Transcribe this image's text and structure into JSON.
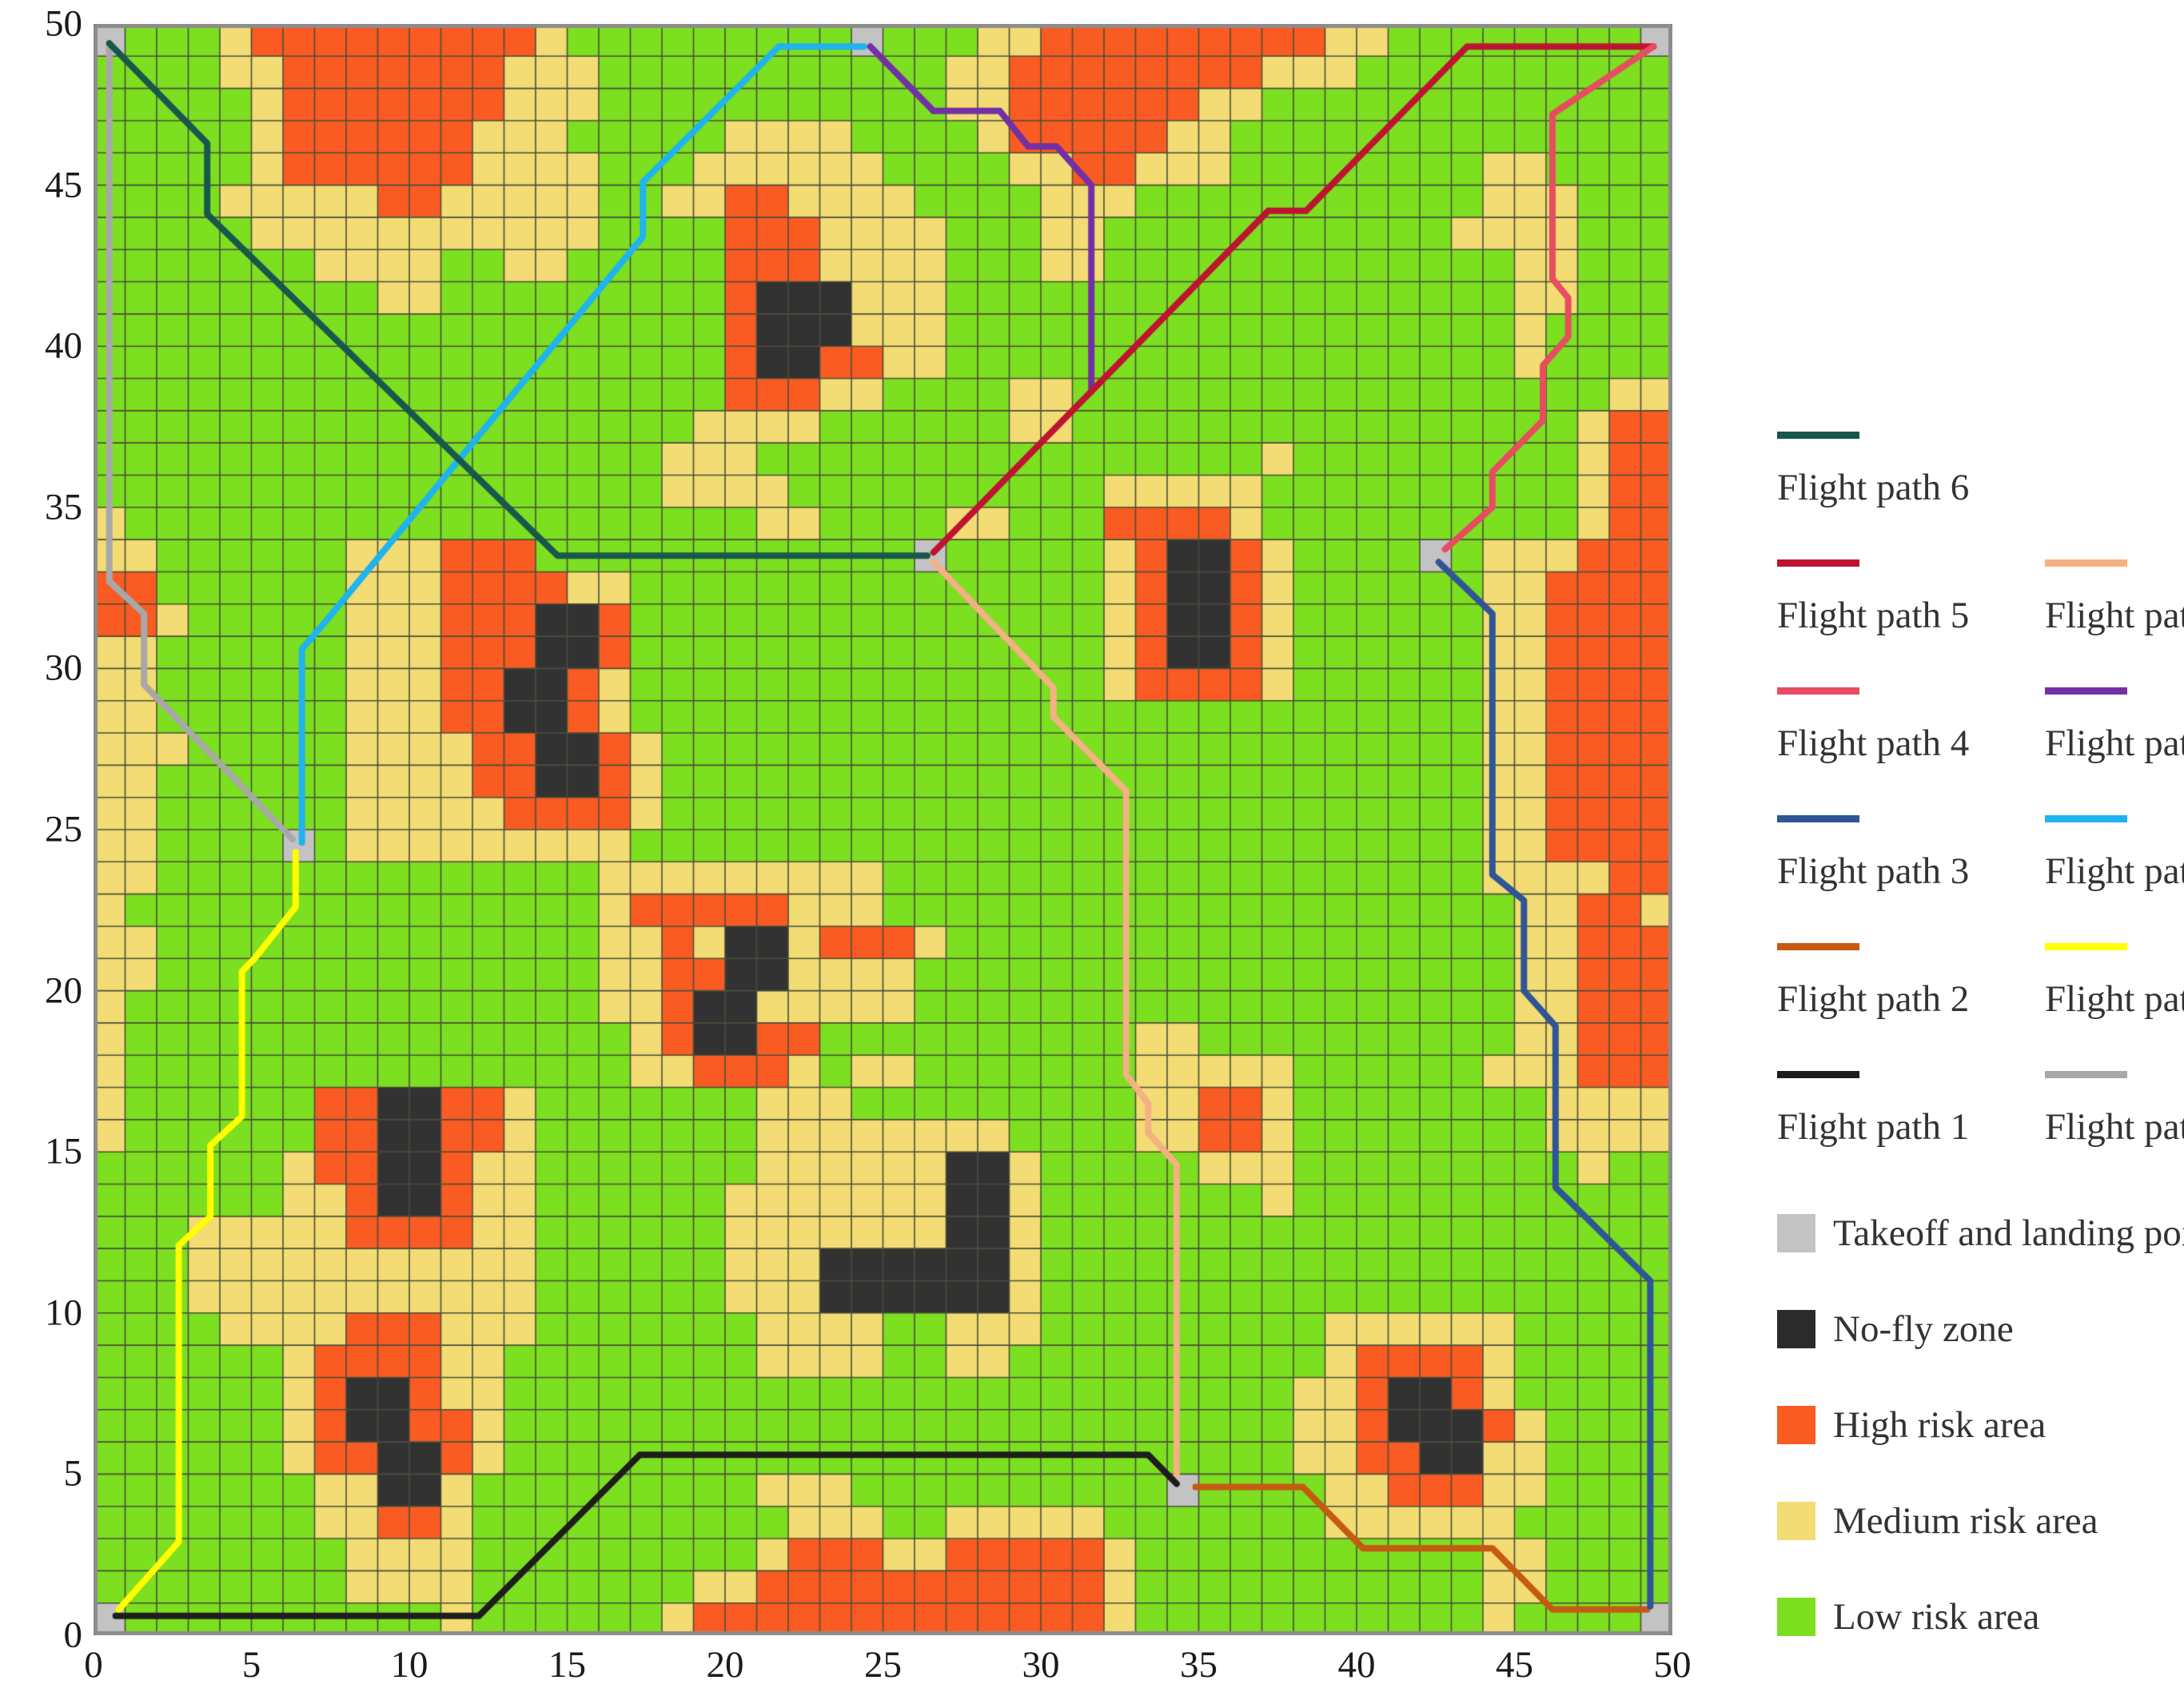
{
  "chart_data": {
    "type": "heatmap",
    "title": "UAV flight paths over gridded risk map",
    "x_axis": {
      "min": 0,
      "max": 50,
      "ticks": [
        0,
        5,
        10,
        15,
        20,
        25,
        30,
        35,
        40,
        45,
        50
      ]
    },
    "y_axis": {
      "min": 0,
      "max": 50,
      "ticks": [
        0,
        5,
        10,
        15,
        20,
        25,
        30,
        35,
        40,
        45,
        50
      ]
    },
    "grid_on": true,
    "cell_codes": {
      "G": "Low risk area",
      "M": "Medium risk area",
      "H": "High risk area",
      "N": "No-fly zone",
      "T": "Takeoff and landing points"
    },
    "colors": {
      "G": "#7cdf1f",
      "M": "#f2dc73",
      "H": "#f95b22",
      "N": "#323232",
      "T": "#c3c3c3",
      "grid_line": "#4a4e3b",
      "border": "#8c8c8c"
    },
    "grid_rows_top_to_bottom": [
      "TGGGMHHHHHHHHHMGGGGGGGGGTGGGMMHHHHHHHHHMMGGGGGGGGT",
      "GGGGMMHHHHHHHMMMGGGGGGGGGGGMMHHHHHHHHMMMGGGGGGGGGG",
      "GGGGGMHHHHHHHMMMGGGGGGGGGGGMMHHHHHHMMGGGGGGGGGGGGG",
      "GGGGGMHHHHHHMMMGGGGGMMMMGGGGMHHHHHMMGGGGGGGGGGGGGG",
      "GGGGGMHHHHHHMMMMGGGMMMMMMGGGGMMHHMMMGGGGGGGGMMGGGG",
      "GGGGMMMMMHHMMMMMGGMMHHMMMMGGGGMMMGGGGGGGGGGGMMMGGG",
      "GGGGGMMMMMMMMMMMGGGGHHHMMMMGGGMMGGGGGGGGGGGMMMMGGG",
      "GGGGGGGMMMMGGMMGGGGGHHHMMMMGGGMMGGGGGGGGGGGGGMMGGG",
      "GGGGGGGGGMMGGGGGGGGGHNNNMMMGGGGGGGGGGGGGGGGGGMMGGG",
      "GGGGGGGGGGGGGGGGGGGGHNNNMMMGGGGGGGGGGGGGGGGGGMGGGG",
      "GGGGGGGGGGGGGGGGGGGGHNNHHMMGGGGGGGGGGGGGGGGGGMGGGG",
      "GGGGGGGGGGGGGGGGGGGGHHHMMGGGGMMGGGGGGGGGGGGGGGGGMM",
      "GGGGGGGGGGGGGGGGGGGMMMMGGGGGGMMGGGGGGGGGGGGGGGGMHH",
      "GGGGGGGGGGGGGGGGGGMMMGGGGGGGGGGGGGGGGMGGGGGGGGGMHH",
      "GGGGGGGGGGGGGGGGGGMMMMGGGGGGGGGGMMMMMGGGGGGGGGGMHH",
      "MGGGGGGGGGGGGGGGGGGGGMMGGGGMMGGGHHHHMGGGGGGGGGGMHH",
      "MMGGGGGGMMMHHHGGGGGGGGGGGGTGGGGGMHNNHMGGGGTGMMMHHH",
      "HHGGGGGGMMMHHHHMMGGGGGGGGGGGGGGGMHNNHMGGGGGGMMHHHH",
      "HHMGGGGGMMMHHHNNHGGGGGGGGGGGGGGGMHNNHMGGGGGGMMHHHH",
      "MMGGGGGGMMMHHHNNHGGGGGGGGGGGGGGGMHNNHMGGGGGGMMHHHH",
      "MMGGGGGGMMMHHNNHMGGGGGGGGGGGGGGGMHHHHMGGGGGGMMHHHH",
      "MMGGGGGGMMMHHNNHMGGGGGGGGGGGGGGGGGGGGGGGGGGGMMHHHH",
      "MMMGGGGGMMMMHHNNHMGGGGGGGGGGGGGGGGGGGGGGGGGGMMHHHH",
      "MMGGGGGGMMMMHHNNHMGGGGGGGGGGGGGGGGGGGGGGGGGGMMHHHH",
      "MMGGGGGGMMMMMHHHHMGGGGGGGGGGGGGGGGGGGGGGGGGGMMHHHH",
      "MMGGGGTGMMMMMMMMMGGGGGGGGGGGGGGGGGGGGGGGGGGGMMHHHH",
      "MMGGGGGGGGGGGGGGMMMMMMMMMGGGGGGGGGGGGGGGGGGGMMMMHH",
      "MGGGGGGGGGGGGGGGMHHHHHMMMGGGGGGGGGGGGGGGGGGGGMMHHM",
      "MMGGGGGGGGGGGGGGMMHMNNMHHHMGGGGGGGGGGGGGGGGGGMMHHH",
      "MMGGGGGGGGGGGGGGMMHHNNMMMMGGGGGGGGGGGGGGGGGGGMMHHH",
      "MGGGGGGGGGGGGGGGMMHNNMMMMMGGGGGGGGGGGGGGGGGGGMMHHH",
      "MGGGGGGGGGGGGGGGGMHNNHHGGGGGGGGGGMMGGGGGGGGGGMMHHH",
      "MGGGGGGGGGGGGGGGGMMHHHMGMMGGGGGGGMMMMMGGGGGGMMMHHH",
      "MGGGGGGHHNNHHMGGGGGGGMMMGGGGGGGGGMMHHMGGGGGGGGMMMM",
      "MGGGGGGHHNNHHMGGGGGGGMMMMMMMMGGGGMMHHMGGGGGGGGMMMM",
      "GGGGGGMHHNNHMMGGGGGGGMMMMMMNNMGGGGGMMMGGGGGGGGGMGG",
      "GGGGGGMMHNNHMMGGGGGGMMMMMMMNNMGGGGGGGMGGGGGGGGGGGG",
      "GGGMMMMMHHHHMMGGGGGGMMMMMMMNNMGGGGGGGGGGGGGGGGGGGG",
      "GGGMMMMMMMMMMMGGGGGGMMMNNNNNNMGGGGGGGGGGGGGGGGGGGG",
      "GGGMMMMMMMMMMMGGGGGGMMMNNNNNNMGGGGGGGGGGGGGGGGGGGG",
      "GGGGMMMMHHHMMMGGGGGGGMMMMGGMMMGGGGGGGGGMMMMMMGGGGG",
      "GGGGGGMHHHHMMGGGGGGGGMMMMGGMMGGGGGGGGGGMHHHHMGGGGG",
      "GGGGGGMHNNHMMGGGGGGGGGGGGGGGGGGGGGGGGGMMHNNHMGGGGG",
      "GGGGGGMHNNHHMGGGGGGGGGGGGGGGGGGGGGGGGGMMHNNNHMGGGG",
      "GGGGGGMHHNNHMGGGGGGGGGGGGGGGGGGGGGGGGGMMHHNNMMGGGG",
      "GGGGGGGMMNNMGGGGGGGGGMMMGGGGGGGGGGTGGGGMMHHHMMGGGG",
      "GGGGGGGMMHHMGGGGGGGGGGMMMGGMMMMMGGGGGGGMMMMMMGGGGG",
      "GGGGGGGGMMMMGGGGGGGGGMHHHMMHHHHHMGGGGGGGGGGGMMGGGG",
      "GGGGGGGGMMMMGGGGGGGMMHHHHHHHHHHHMGGGGGGGGGGGMMGGGG",
      "TGGGGGGGGGGMGGGGGGMHHHHHHHHHHHHHMGGGGGGGGGGGMGGGGT"
    ],
    "takeoff_points": [
      [
        0.5,
        0.5
      ],
      [
        0.5,
        49.5
      ],
      [
        24.5,
        49.5
      ],
      [
        49.5,
        49.5
      ],
      [
        6.5,
        24.5
      ],
      [
        26.5,
        33.5
      ],
      [
        42.5,
        33.5
      ],
      [
        34.5,
        4.5
      ],
      [
        49.5,
        0.5
      ]
    ],
    "flight_paths": [
      {
        "name": "Flight path 7",
        "color": "#a8a8a8",
        "points": [
          [
            0.5,
            49.4
          ],
          [
            0.5,
            32.7
          ],
          [
            1.6,
            31.7
          ],
          [
            1.6,
            29.5
          ],
          [
            6.3,
            24.7
          ]
        ]
      },
      {
        "name": "Flight path 9",
        "color": "#1fb3f0",
        "points": [
          [
            6.6,
            24.6
          ],
          [
            6.6,
            30.6
          ],
          [
            7.3,
            31.4
          ],
          [
            17.4,
            43.4
          ],
          [
            17.4,
            45.1
          ],
          [
            21.7,
            49.3
          ],
          [
            24.4,
            49.3
          ]
        ]
      },
      {
        "name": "Flight path 8",
        "color": "#ffff00",
        "points": [
          [
            6.4,
            24.3
          ],
          [
            6.4,
            22.6
          ],
          [
            5.1,
            21.0
          ],
          [
            4.7,
            20.6
          ],
          [
            4.7,
            16.1
          ],
          [
            3.7,
            15.2
          ],
          [
            3.7,
            13.0
          ],
          [
            2.7,
            12.1
          ],
          [
            2.7,
            2.9
          ],
          [
            0.8,
            0.8
          ]
        ]
      },
      {
        "name": "Flight path 6",
        "color": "#18584c",
        "points": [
          [
            0.5,
            49.4
          ],
          [
            3.6,
            46.3
          ],
          [
            3.6,
            44.1
          ],
          [
            14.7,
            33.5
          ],
          [
            26.4,
            33.5
          ]
        ]
      },
      {
        "name": "Flight path 10",
        "color": "#7330a6",
        "points": [
          [
            24.6,
            49.3
          ],
          [
            26.6,
            47.3
          ],
          [
            28.7,
            47.3
          ],
          [
            29.6,
            46.2
          ],
          [
            30.5,
            46.2
          ],
          [
            31.6,
            45.0
          ],
          [
            31.6,
            38.6
          ]
        ]
      },
      {
        "name": "Flight path 5",
        "color": "#bf1332",
        "points": [
          [
            26.6,
            33.6
          ],
          [
            37.2,
            44.2
          ],
          [
            38.4,
            44.2
          ],
          [
            43.5,
            49.3
          ],
          [
            49.4,
            49.3
          ]
        ]
      },
      {
        "name": "Flight path 11",
        "color": "#f4b183",
        "points": [
          [
            26.6,
            33.3
          ],
          [
            30.4,
            29.4
          ],
          [
            30.4,
            28.5
          ],
          [
            32.7,
            26.2
          ],
          [
            32.7,
            17.4
          ],
          [
            33.4,
            16.5
          ],
          [
            33.4,
            15.6
          ],
          [
            34.3,
            14.6
          ],
          [
            34.3,
            5.0
          ]
        ]
      },
      {
        "name": "Flight path 1",
        "color": "#1d1d1d",
        "points": [
          [
            0.7,
            0.6
          ],
          [
            12.2,
            0.6
          ],
          [
            17.3,
            5.6
          ],
          [
            33.4,
            5.6
          ],
          [
            34.3,
            4.7
          ]
        ]
      },
      {
        "name": "Flight path 2",
        "color": "#c55a11",
        "points": [
          [
            34.9,
            4.6
          ],
          [
            38.3,
            4.6
          ],
          [
            40.2,
            2.7
          ],
          [
            44.3,
            2.7
          ],
          [
            46.2,
            0.8
          ],
          [
            49.2,
            0.8
          ]
        ]
      },
      {
        "name": "Flight path 4",
        "color": "#e74c60",
        "points": [
          [
            49.4,
            49.3
          ],
          [
            46.2,
            47.2
          ],
          [
            46.2,
            42.1
          ],
          [
            46.7,
            41.5
          ],
          [
            46.7,
            40.3
          ],
          [
            45.9,
            39.4
          ],
          [
            45.9,
            37.7
          ],
          [
            44.3,
            36.1
          ],
          [
            44.3,
            35.0
          ],
          [
            42.8,
            33.7
          ]
        ]
      },
      {
        "name": "Flight path 3",
        "color": "#2f5597",
        "points": [
          [
            42.6,
            33.3
          ],
          [
            44.3,
            31.7
          ],
          [
            44.3,
            23.6
          ],
          [
            45.3,
            22.8
          ],
          [
            45.3,
            20.0
          ],
          [
            46.3,
            18.9
          ],
          [
            46.3,
            13.9
          ],
          [
            49.3,
            11.0
          ],
          [
            49.3,
            0.9
          ]
        ]
      }
    ]
  },
  "legend": {
    "path_columns": [
      {
        "entries": [
          {
            "label": "Flight path 6",
            "color": "#18584c"
          },
          {
            "label": "Flight path 5",
            "color": "#bf1332"
          },
          {
            "label": "Flight path 4",
            "color": "#e74c60"
          },
          {
            "label": "Flight path 3",
            "color": "#2f5597"
          },
          {
            "label": "Flight path 2",
            "color": "#c55a11"
          },
          {
            "label": "Flight path 1",
            "color": "#1d1d1d"
          }
        ]
      },
      {
        "entries": [
          {
            "label": "Flight path 11",
            "color": "#f4b183"
          },
          {
            "label": "Flight path 10",
            "color": "#7330a6"
          },
          {
            "label": "Flight path 9",
            "color": "#1fb3f0"
          },
          {
            "label": "Flight path 8",
            "color": "#ffff00"
          },
          {
            "label": "Flight path 7",
            "color": "#a8a8a8"
          }
        ]
      }
    ],
    "area_entries": [
      {
        "label": "Takeoff and landing points",
        "color": "#c3c3c3"
      },
      {
        "label": "No-fly zone",
        "color": "#2b2b2b"
      },
      {
        "label": "High risk area",
        "color": "#f95b22"
      },
      {
        "label": "Medium risk area",
        "color": "#f2dc73"
      },
      {
        "label": "Low risk area",
        "color": "#7cdf1f"
      }
    ]
  }
}
